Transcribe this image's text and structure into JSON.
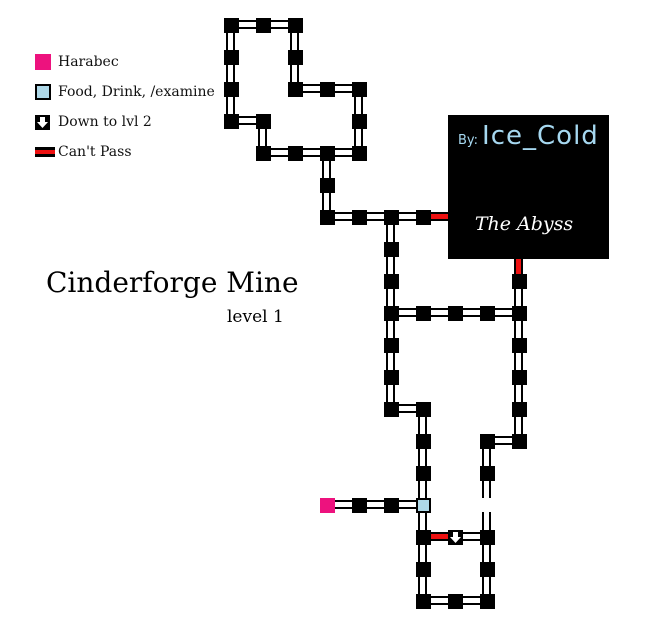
{
  "title": {
    "main": "Cinderforge Mine",
    "sub": "level 1"
  },
  "legend": {
    "items": [
      {
        "icon": "harabec-square",
        "label": "Harabec"
      },
      {
        "icon": "examine-square",
        "label": "Food, Drink, /examine"
      },
      {
        "icon": "down-arrow",
        "label": "Down to lvl 2"
      },
      {
        "icon": "cant-pass-bar",
        "label": "Can't Pass"
      }
    ]
  },
  "info_box": {
    "by_label": "By:",
    "author": "Ice_Cold",
    "zone": "The Abyss"
  },
  "colors": {
    "harabec_pink": "#ed127e",
    "examine_blue": "#aed8e8",
    "cant_pass_red": "#ee1111",
    "author_text_blue": "#a6d8f0",
    "zone_text_white": "#ffffff",
    "room_black": "#000000"
  },
  "map": {
    "grid": {
      "origin_x": 231,
      "origin_y": 25,
      "step": 32,
      "room_size": 15
    },
    "rooms": [
      [
        0,
        0,
        "n"
      ],
      [
        1,
        0,
        "n"
      ],
      [
        2,
        0,
        "n"
      ],
      [
        0,
        1,
        "n"
      ],
      [
        2,
        1,
        "n"
      ],
      [
        0,
        2,
        "n"
      ],
      [
        2,
        2,
        "n"
      ],
      [
        3,
        2,
        "n"
      ],
      [
        4,
        2,
        "n"
      ],
      [
        0,
        3,
        "n"
      ],
      [
        1,
        3,
        "n"
      ],
      [
        4,
        3,
        "n"
      ],
      [
        1,
        4,
        "n"
      ],
      [
        2,
        4,
        "n"
      ],
      [
        3,
        4,
        "n"
      ],
      [
        4,
        4,
        "n"
      ],
      [
        3,
        5,
        "n"
      ],
      [
        3,
        6,
        "n"
      ],
      [
        4,
        6,
        "n"
      ],
      [
        5,
        6,
        "n"
      ],
      [
        6,
        6,
        "n"
      ],
      [
        5,
        7,
        "n"
      ],
      [
        5,
        8,
        "n"
      ],
      [
        9,
        8,
        "n"
      ],
      [
        5,
        9,
        "n"
      ],
      [
        6,
        9,
        "n"
      ],
      [
        7,
        9,
        "n"
      ],
      [
        8,
        9,
        "n"
      ],
      [
        9,
        9,
        "n"
      ],
      [
        5,
        10,
        "n"
      ],
      [
        9,
        10,
        "n"
      ],
      [
        5,
        11,
        "n"
      ],
      [
        9,
        11,
        "n"
      ],
      [
        5,
        12,
        "n"
      ],
      [
        6,
        12,
        "n"
      ],
      [
        9,
        12,
        "n"
      ],
      [
        6,
        13,
        "n"
      ],
      [
        8,
        13,
        "n"
      ],
      [
        9,
        13,
        "n"
      ],
      [
        6,
        14,
        "n"
      ],
      [
        8,
        14,
        "n"
      ],
      [
        3,
        15,
        "harabec"
      ],
      [
        4,
        15,
        "n"
      ],
      [
        5,
        15,
        "n"
      ],
      [
        6,
        15,
        "examine"
      ],
      [
        6,
        16,
        "n"
      ],
      [
        7,
        16,
        "down"
      ],
      [
        8,
        16,
        "n"
      ],
      [
        6,
        17,
        "n"
      ],
      [
        8,
        17,
        "n"
      ],
      [
        6,
        18,
        "n"
      ],
      [
        7,
        18,
        "n"
      ],
      [
        8,
        18,
        "n"
      ]
    ],
    "links": [
      [
        0,
        0,
        "h",
        "n"
      ],
      [
        1,
        0,
        "h",
        "n"
      ],
      [
        0,
        0,
        "v",
        "n"
      ],
      [
        2,
        0,
        "v",
        "n"
      ],
      [
        0,
        1,
        "v",
        "n"
      ],
      [
        2,
        1,
        "v",
        "n"
      ],
      [
        2,
        2,
        "h",
        "n"
      ],
      [
        3,
        2,
        "h",
        "n"
      ],
      [
        0,
        2,
        "v",
        "n"
      ],
      [
        4,
        2,
        "v",
        "n"
      ],
      [
        0,
        3,
        "h",
        "n"
      ],
      [
        1,
        3,
        "v",
        "n"
      ],
      [
        4,
        3,
        "v",
        "n"
      ],
      [
        1,
        4,
        "h",
        "n"
      ],
      [
        2,
        4,
        "h",
        "n"
      ],
      [
        3,
        4,
        "h",
        "n"
      ],
      [
        3,
        4,
        "v",
        "n"
      ],
      [
        3,
        5,
        "v",
        "n"
      ],
      [
        3,
        6,
        "h",
        "n"
      ],
      [
        4,
        6,
        "h",
        "n"
      ],
      [
        5,
        6,
        "h",
        "n"
      ],
      [
        6,
        6,
        "h",
        "red"
      ],
      [
        5,
        6,
        "v",
        "n"
      ],
      [
        5,
        7,
        "v",
        "n"
      ],
      [
        9,
        7,
        "v",
        "red"
      ],
      [
        5,
        8,
        "v",
        "n"
      ],
      [
        9,
        8,
        "v",
        "n"
      ],
      [
        5,
        9,
        "h",
        "n"
      ],
      [
        6,
        9,
        "h",
        "n"
      ],
      [
        7,
        9,
        "h",
        "n"
      ],
      [
        8,
        9,
        "h",
        "n"
      ],
      [
        5,
        9,
        "v",
        "n"
      ],
      [
        9,
        9,
        "v",
        "n"
      ],
      [
        5,
        10,
        "v",
        "n"
      ],
      [
        9,
        10,
        "v",
        "n"
      ],
      [
        5,
        11,
        "v",
        "n"
      ],
      [
        9,
        11,
        "v",
        "n"
      ],
      [
        5,
        12,
        "h",
        "n"
      ],
      [
        6,
        12,
        "v",
        "n"
      ],
      [
        9,
        12,
        "v",
        "n"
      ],
      [
        8,
        13,
        "h",
        "n"
      ],
      [
        6,
        13,
        "v",
        "n"
      ],
      [
        8,
        13,
        "v",
        "n"
      ],
      [
        6,
        14,
        "v",
        "n"
      ],
      [
        8,
        14,
        "v",
        "n"
      ],
      [
        3,
        15,
        "h",
        "n"
      ],
      [
        4,
        15,
        "h",
        "n"
      ],
      [
        5,
        15,
        "h",
        "n"
      ],
      [
        6,
        15,
        "v",
        "n"
      ],
      [
        8,
        15,
        "v",
        "n"
      ],
      [
        6,
        16,
        "h",
        "red"
      ],
      [
        7,
        16,
        "h",
        "n"
      ],
      [
        6,
        16,
        "v",
        "n"
      ],
      [
        8,
        16,
        "v",
        "n"
      ],
      [
        6,
        17,
        "v",
        "n"
      ],
      [
        8,
        17,
        "v",
        "n"
      ],
      [
        6,
        18,
        "h",
        "n"
      ],
      [
        7,
        18,
        "h",
        "n"
      ]
    ],
    "info_box_rect": {
      "x": 448,
      "y": 115,
      "w": 161,
      "h": 144
    }
  }
}
